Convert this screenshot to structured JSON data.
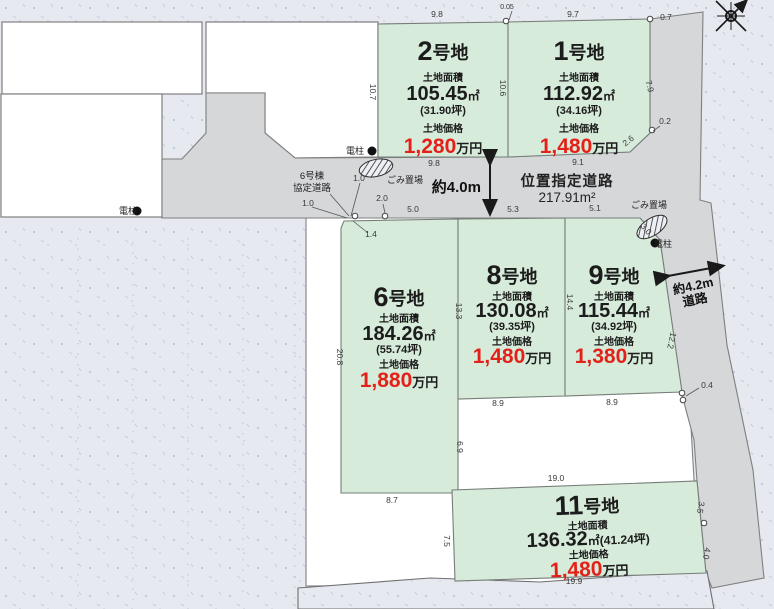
{
  "plots": [
    {
      "id": "2",
      "num": "2",
      "suffix": "号地",
      "area_label": "土地面積",
      "area_value": "105.45",
      "area_unit": "㎡",
      "tsubo": "(31.90坪)",
      "price_label": "土地価格",
      "price_value": "1,280",
      "price_unit": "万円"
    },
    {
      "id": "1",
      "num": "1",
      "suffix": "号地",
      "area_label": "土地面積",
      "area_value": "112.92",
      "area_unit": "㎡",
      "tsubo": "(34.16坪)",
      "price_label": "土地価格",
      "price_value": "1,480",
      "price_unit": "万円"
    },
    {
      "id": "6",
      "num": "6",
      "suffix": "号地",
      "area_label": "土地面積",
      "area_value": "184.26",
      "area_unit": "㎡",
      "tsubo": "(55.74坪)",
      "price_label": "土地価格",
      "price_value": "1,880",
      "price_unit": "万円"
    },
    {
      "id": "8",
      "num": "8",
      "suffix": "号地",
      "area_label": "土地面積",
      "area_value": "130.08",
      "area_unit": "㎡",
      "tsubo": "(39.35坪)",
      "price_label": "土地価格",
      "price_value": "1,480",
      "price_unit": "万円"
    },
    {
      "id": "9",
      "num": "9",
      "suffix": "号地",
      "area_label": "土地面積",
      "area_value": "115.44",
      "area_unit": "㎡",
      "tsubo": "(34.92坪)",
      "price_label": "土地価格",
      "price_value": "1,380",
      "price_unit": "万円"
    },
    {
      "id": "11",
      "num": "11",
      "suffix": "号地",
      "area_label": "土地面積",
      "area_value": "136.32",
      "area_unit": "㎡",
      "tsubo": "(41.24坪)",
      "price_label": "土地価格",
      "price_value": "1,480",
      "price_unit": "万円"
    }
  ],
  "roads": {
    "designated_road_label": "位置指定道路",
    "designated_road_area": "217.91m²",
    "road_width_label": "約4.0m",
    "side_road_width": "約4.2m",
    "side_road_suffix": "道路",
    "agreement_road_line1": "6号棟",
    "agreement_road_line2": "協定道路"
  },
  "landmarks": {
    "garbage_label": "ごみ置場",
    "pole_label": "電柱"
  },
  "dimensions": {
    "top_98": "9.8",
    "top_005": "0.05",
    "top_97": "9.7",
    "top_07": "0.7",
    "left_107": "10.7",
    "mid_106": "10.6",
    "right_79": "7.9",
    "right_02": "0.2",
    "diag_26": "2.6",
    "road_98": "9.8",
    "road_91": "9.1",
    "k10a": "1.0",
    "k10b": "1.0",
    "k20": "2.0",
    "k14": "1.4",
    "k50": "5.0",
    "k53": "5.3",
    "k51": "5.1",
    "k30": "3.0",
    "l208": "20.8",
    "m133": "13.3",
    "m144": "14.4",
    "r122": "12.2",
    "r04": "0.4",
    "g89a": "8.9",
    "g89b": "8.9",
    "g69": "6.9",
    "g190": "19.0",
    "g87": "8.7",
    "g75": "7.5",
    "r35": "3.5",
    "r40": "4.0",
    "b199": "19.9"
  },
  "colors": {
    "plot_green": "#d7ebda",
    "road_gray": "#d6d7d9",
    "background": "#e6e9f0",
    "price_red": "#e32119"
  }
}
